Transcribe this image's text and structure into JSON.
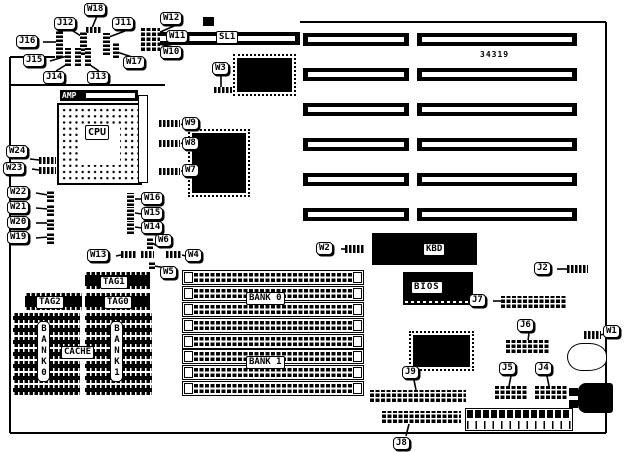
{
  "colors": {
    "ink": "#000000",
    "paper": "#ffffff"
  },
  "labels": {
    "part_number": "34319",
    "W1": "W1",
    "W2": "W2",
    "W3": "W3",
    "W4": "W4",
    "W5": "W5",
    "W6": "W6",
    "W7": "W7",
    "W8": "W8",
    "W9": "W9",
    "W10": "W10",
    "W11": "W11",
    "W12": "W12",
    "W13": "W13",
    "W14": "W14",
    "W15": "W15",
    "W16": "W16",
    "W17": "W17",
    "W18": "W18",
    "W19": "W19",
    "W20": "W20",
    "W21": "W21",
    "W22": "W22",
    "W23": "W23",
    "W24": "W24",
    "J2": "J2",
    "J4": "J4",
    "J5": "J5",
    "J6": "J6",
    "J7": "J7",
    "J8": "J8",
    "J9": "J9",
    "J11": "J11",
    "J12": "J12",
    "J13": "J13",
    "J14": "J14",
    "J15": "J15",
    "J16": "J16",
    "SL1": "SL1",
    "AMP": "AMP",
    "CPU": "CPU",
    "KBD": "KBD",
    "BIOS": "BIOS",
    "TAG0": "TAG0",
    "TAG1": "TAG1",
    "TAG2": "TAG2",
    "CACHE": "CACHE",
    "BANK0_V": "BANK0",
    "BANK1_V": "BANK1",
    "BANK0_SIMM": "BANK 0",
    "BANK1_SIMM": "BANK 1"
  }
}
